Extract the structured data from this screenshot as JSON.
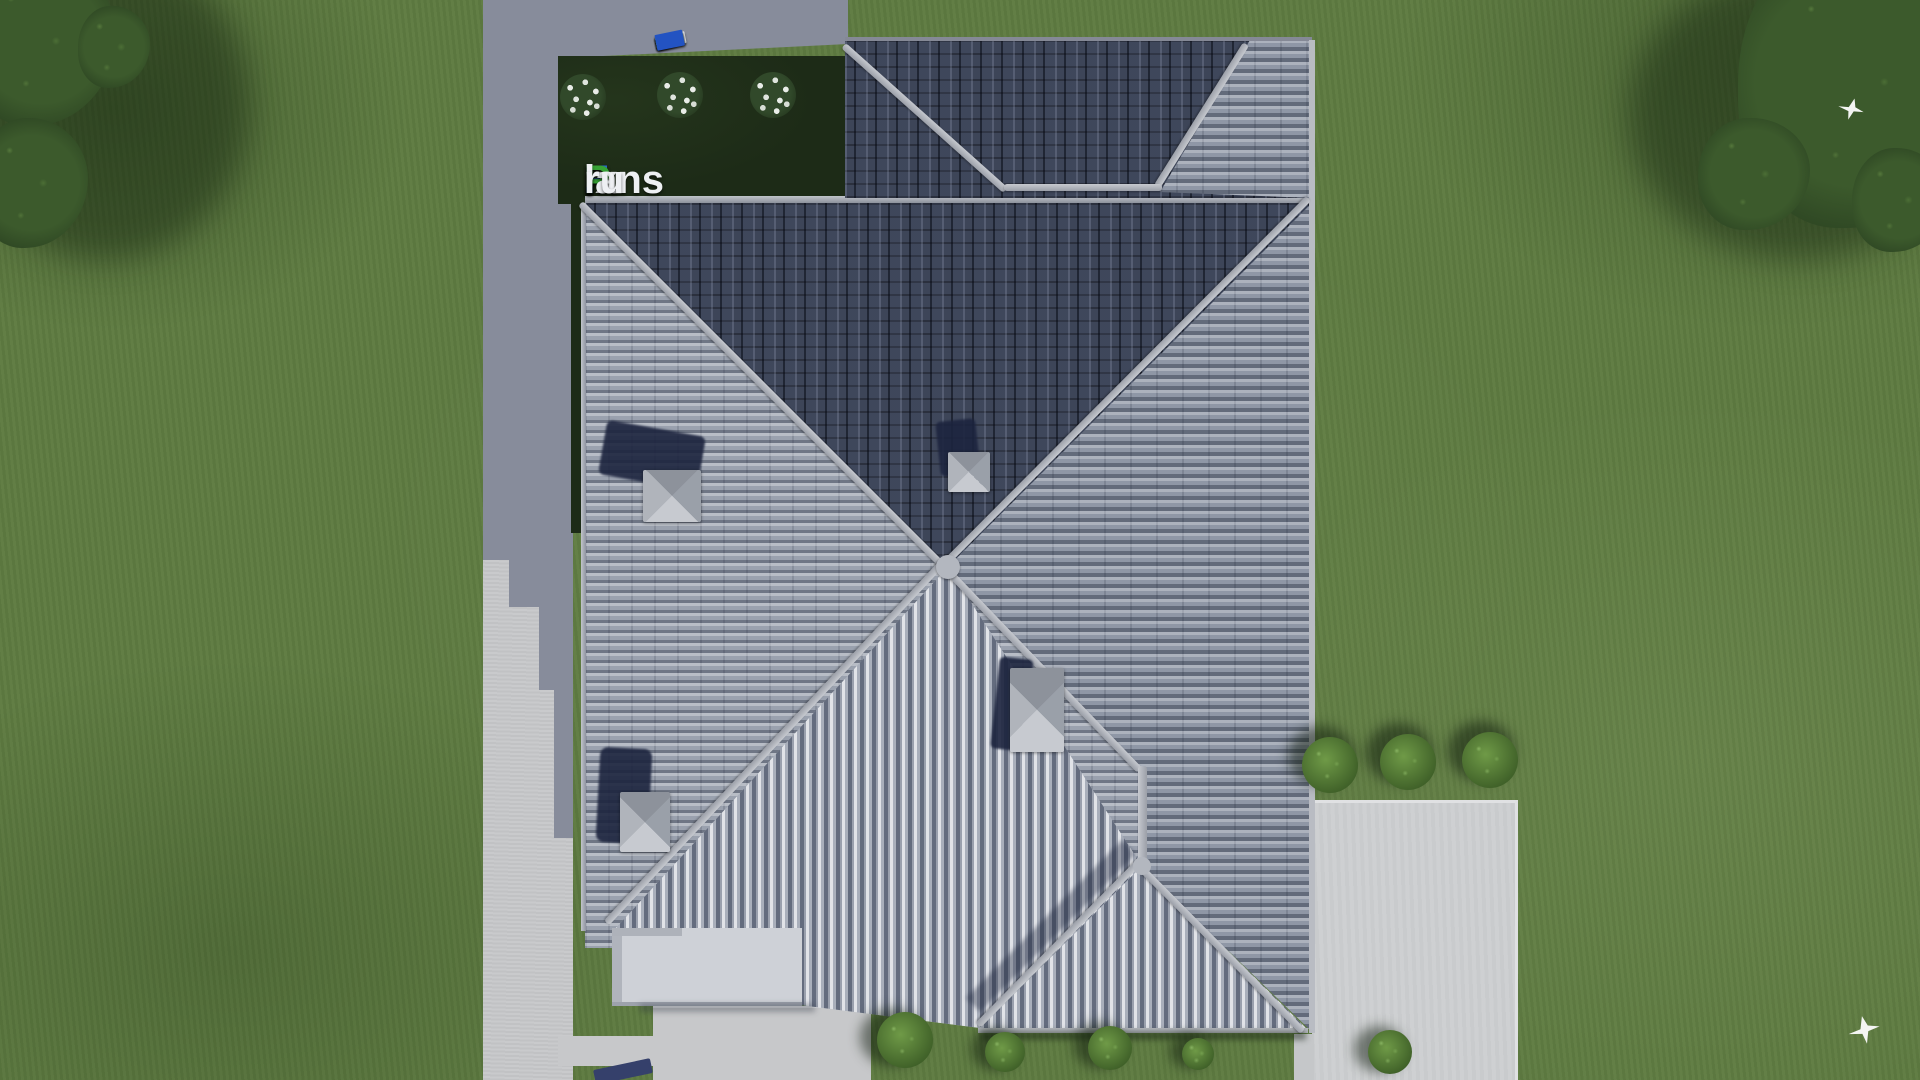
{
  "scene": {
    "type": "aerial-3d-architectural-render",
    "subject": "Top-down view of a hip-roofed house with gray tile roof, lawn, side road, rear garden bed, patios and trees",
    "watermark": {
      "full": "FixPlans.ru",
      "parts": {
        "f": "F",
        "ix": "ix",
        "p": "P",
        "lans": "lans",
        "dot": ".",
        "ru": "ru"
      }
    },
    "counts": {
      "roof_vents": 4,
      "flower_bushes": 3,
      "round_bushes_right": 3,
      "bushes_bottom": 5,
      "birds": 2,
      "fence_segments": 11
    }
  },
  "palette": {
    "grass": "#5e7b41",
    "bed": "#1d2b17",
    "pavement": "#878c9b",
    "concrete": "#c7c8ca",
    "patio": "#cdcfd1",
    "roofLight": "#9aa1ae",
    "roofEast": "#8f97a6",
    "roofDark": "#3d4558",
    "stripeLight": "#e1e3e8",
    "stripeDark": "#646c7e",
    "ridge": "#c6c9cf",
    "logoBlue": "#2a6cd6",
    "logoGreen": "#37a336",
    "logoWhite": "#eef0f3",
    "fenceBlue": "#2353c2",
    "fenceGreen": "#2f9e33",
    "fenceWhite": "#e9ebee",
    "treeDark": "#24391d",
    "treeMid": "#3c5a2c",
    "bushGreen": "#3f6028",
    "bird": "#f4f5f3"
  }
}
